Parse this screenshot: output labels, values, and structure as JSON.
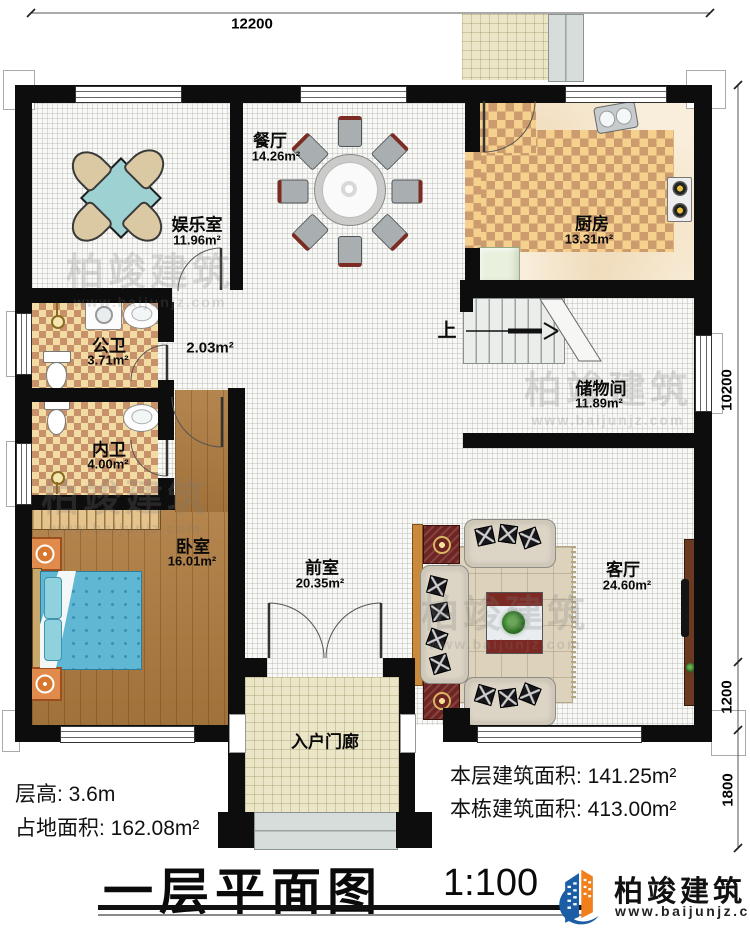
{
  "dim": {
    "top": "12200",
    "right1": "10200",
    "right2": "1200",
    "right3": "1800"
  },
  "rooms": [
    {
      "name": "娱乐室",
      "area": "11.96m²"
    },
    {
      "name": "餐厅",
      "area": "14.26m²"
    },
    {
      "name": "厨房",
      "area": "13.31m²"
    },
    {
      "name": "公卫",
      "area": "3.71m²"
    },
    {
      "name": "",
      "area": "2.03m²"
    },
    {
      "name": "内卫",
      "area": "4.00m²"
    },
    {
      "name": "储物间",
      "area": "11.89m²"
    },
    {
      "name": "卧室",
      "area": "16.01m²"
    },
    {
      "name": "前室",
      "area": "20.35m²"
    },
    {
      "name": "客厅",
      "area": "24.60m²"
    },
    {
      "name": "入户门廊",
      "area": ""
    }
  ],
  "stairs": {
    "up": "上"
  },
  "info": {
    "floor_height": "层高: 3.6m",
    "land_area": "占地面积: 162.08m²",
    "floor_area": "本层建筑面积: 141.25m²",
    "building_area": "本栋建筑面积: 413.00m²"
  },
  "title": {
    "name": "一层平面图",
    "scale": "1:100"
  },
  "brand": {
    "name": "柏竣建筑",
    "site": "www.baijunjz.com"
  },
  "colors": {
    "wall": "#0d0d0d",
    "logo_blue": "#1b5ea6",
    "logo_orange": "#f07f1c",
    "bed": "#5fb7d3",
    "checker": "#c7916a"
  }
}
